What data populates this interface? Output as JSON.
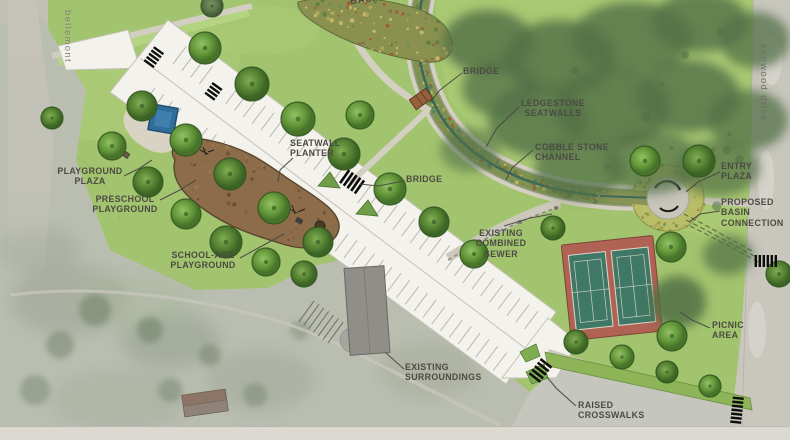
{
  "map_labels": {
    "basin": "BASIN",
    "bridge_top": "BRIDGE",
    "ledgestone_seatwalls": "LEDGESTONE SEATWALLS",
    "cobble_stone_channel": "COBBLE STONE CHANNEL",
    "entry_plaza": "ENTRY PLAZA",
    "proposed_basin_connection": "PROPOSED BASIN CONNECTION",
    "seatwall_planter": "SEATWALL PLANTER",
    "playground_plaza": "PLAYGROUND PLAZA",
    "preschool_playground": "PRESCHOOL PLAYGROUND",
    "school_age_playground": "SCHOOL-AGE PLAYGROUND",
    "bridge_mid": "BRIDGE",
    "existing_combined_sewer": "EXISTING COMBINED SEWER",
    "picnic_area": "PICNIC AREA",
    "existing_surroundings": "EXISTING SURROUNDINGS",
    "raised_crosswalks": "RAISED CROSSWALKS"
  },
  "streets": {
    "west": "bellemont",
    "east": "kenwood drive"
  },
  "colors": {
    "grass": "#a3c46e",
    "lawn_light": "#b0ce78",
    "tree_canopy": "#639638",
    "existing_tree_mass": "#527047",
    "aerial_faded": "#b9beb1",
    "paving_white": "#f3f2ed",
    "road_gray": "#c9c6bd",
    "path_tan": "#d3cfc2",
    "playground_surface": "#8d6c49",
    "tennis_apron": "#b06355",
    "tennis_court": "#3f7866",
    "channel_teal": "#3c685c",
    "planting_olive": "#7e9150",
    "pool_blue": "#2f6d9c",
    "label_text": "#4b4a43"
  }
}
